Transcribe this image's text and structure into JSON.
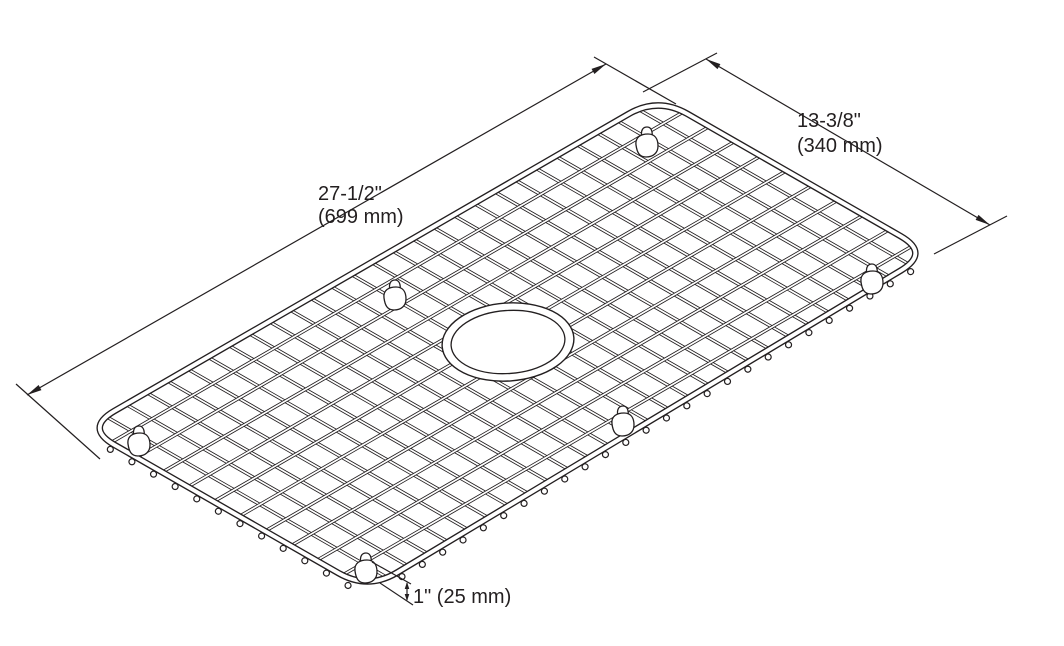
{
  "dimensions": {
    "length": {
      "inches": "27-1/2\"",
      "mm": "(699 mm)"
    },
    "width": {
      "inches": "13-3/8\"",
      "mm": "(340 mm)"
    },
    "height": {
      "label": "1\" (25 mm)"
    }
  },
  "colors": {
    "line": "#231f20",
    "background": "#ffffff"
  }
}
